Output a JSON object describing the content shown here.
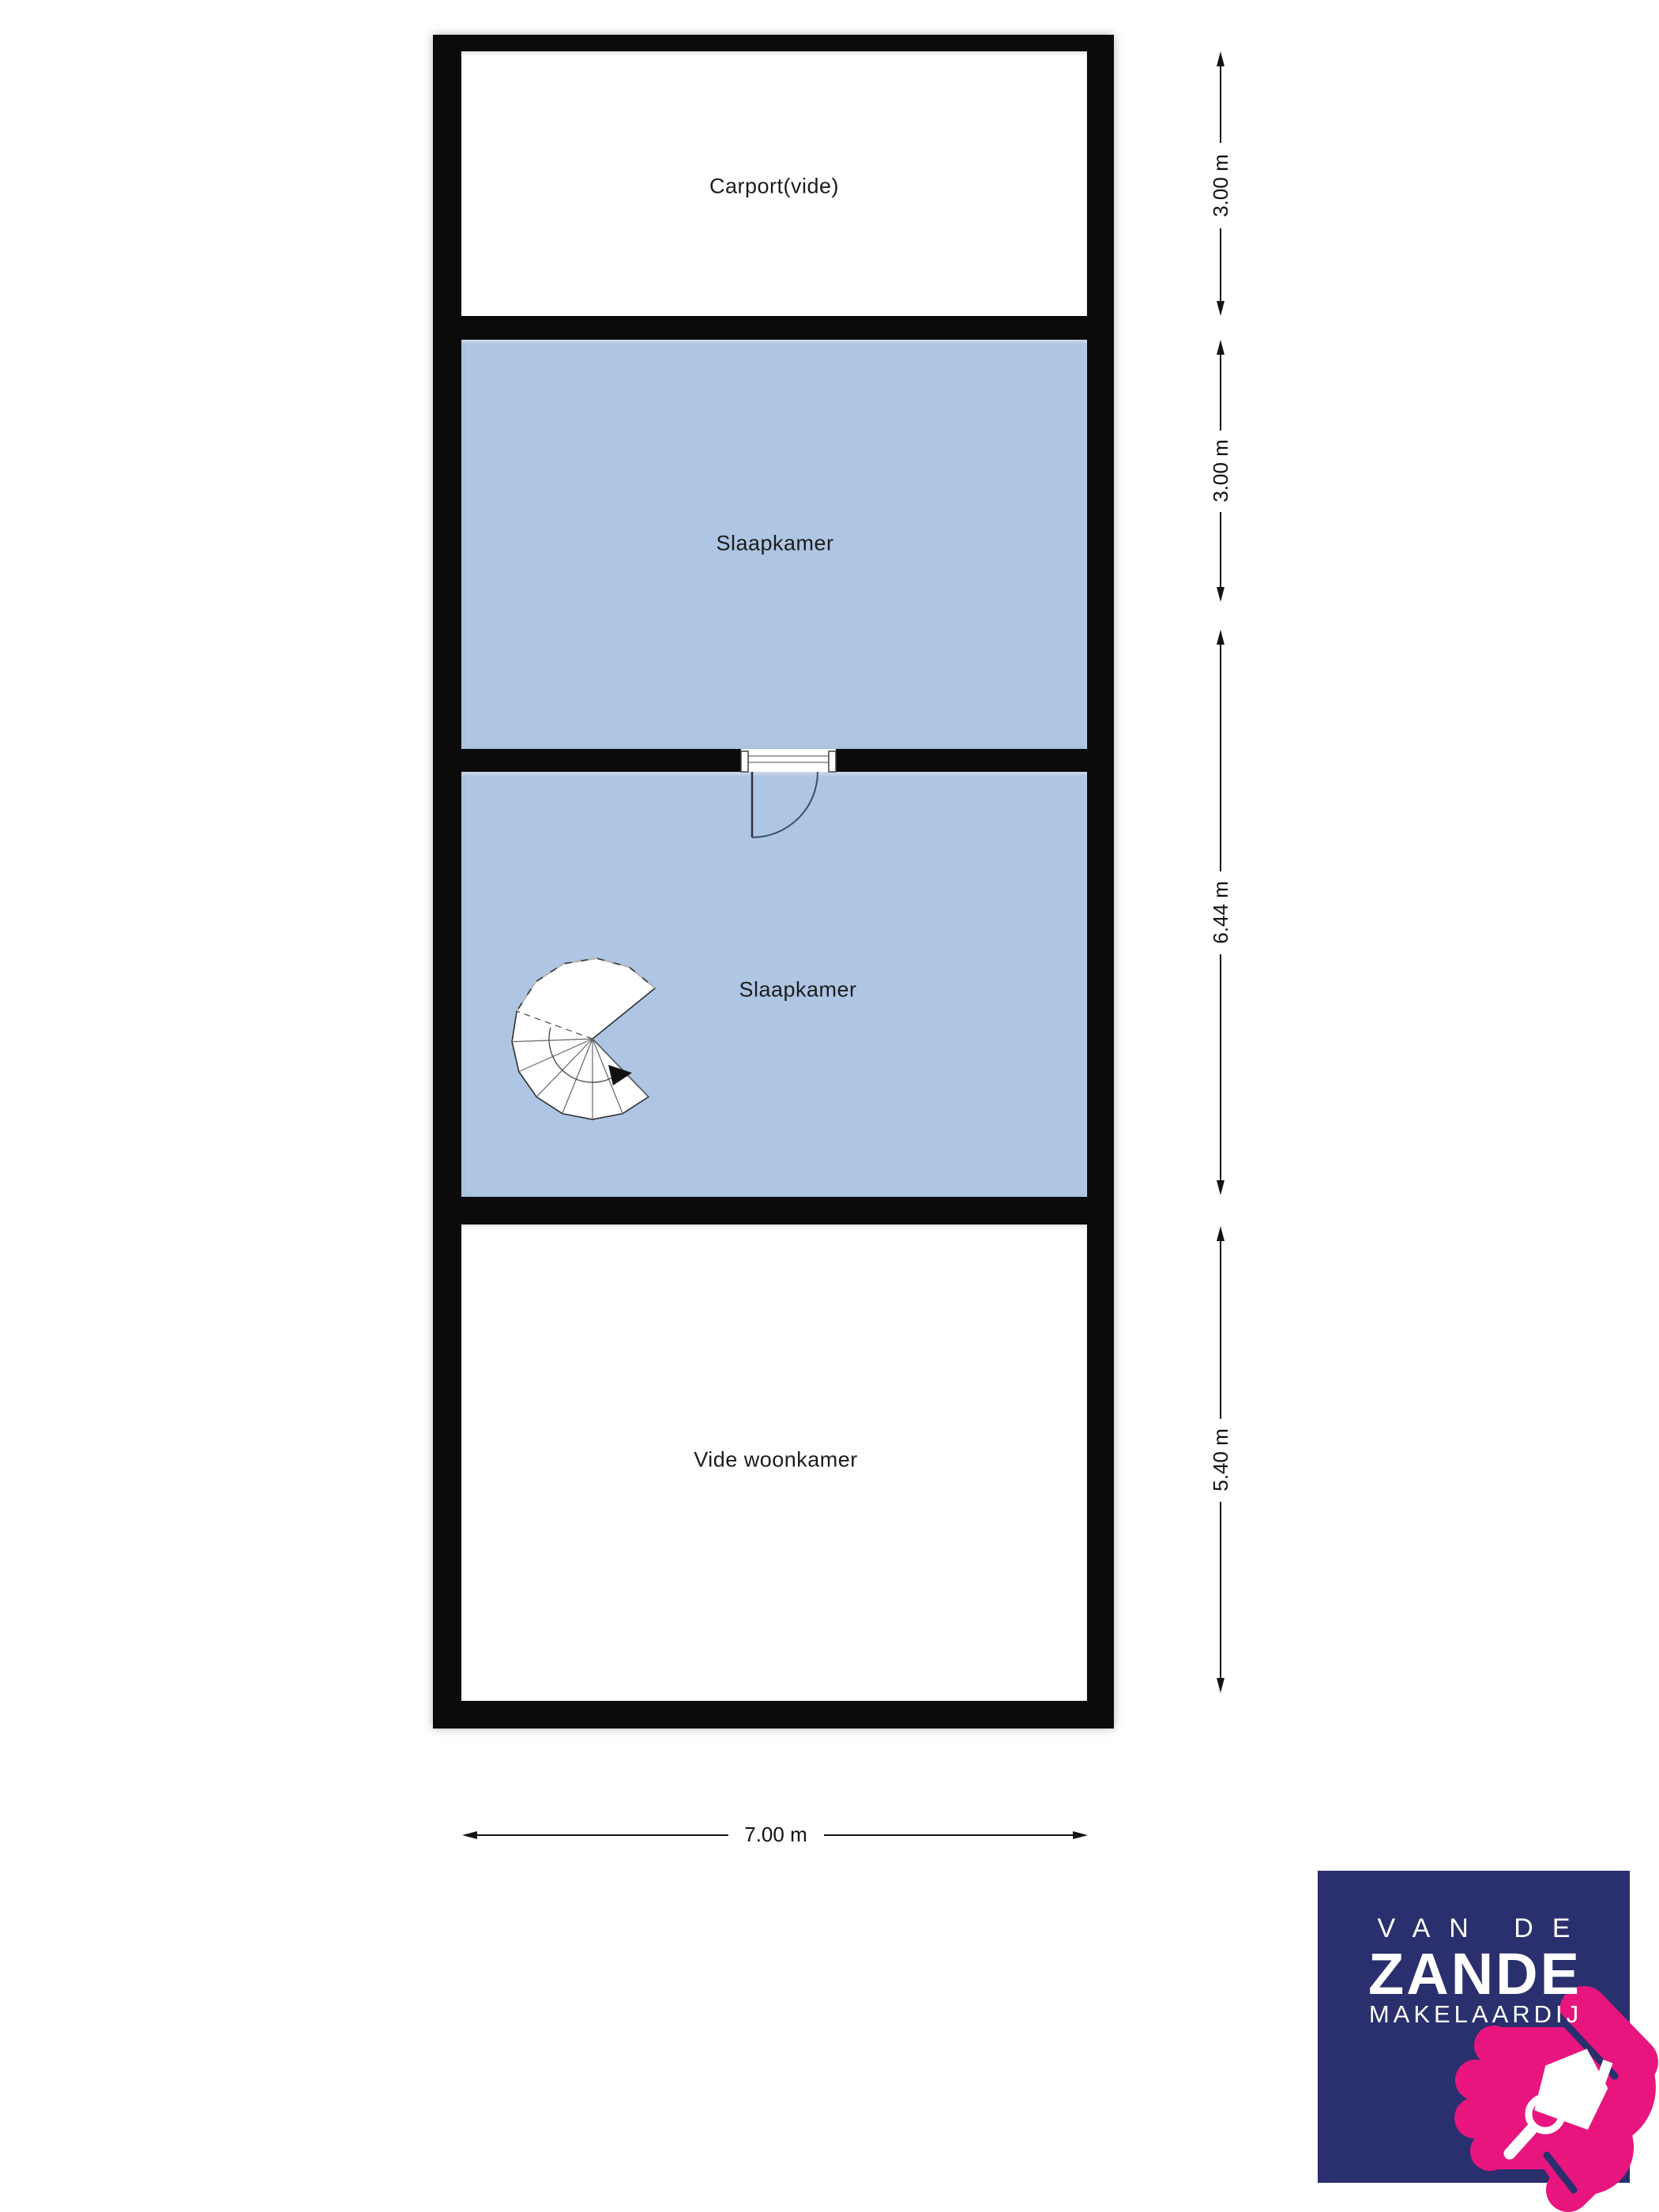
{
  "floorplan": {
    "rooms": [
      {
        "name": "carport",
        "label": "Carport(vide)",
        "fill": "white"
      },
      {
        "name": "slaapkamer-boven",
        "label": "Slaapkamer",
        "fill": "blue"
      },
      {
        "name": "slaapkamer-onder",
        "label": "Slaapkamer",
        "fill": "blue"
      },
      {
        "name": "vide-woonkamer",
        "label": "Vide woonkamer",
        "fill": "white"
      }
    ],
    "features": [
      "door-swing",
      "spiral-staircase"
    ],
    "colors": {
      "wall": "#0b0b0b",
      "room_blue": "#aec6e3",
      "room_white": "#ffffff"
    }
  },
  "dimensions": {
    "vertical": [
      {
        "label": "3.00 m"
      },
      {
        "label": "3.00 m"
      },
      {
        "label": "6.44 m"
      },
      {
        "label": "5.40 m"
      }
    ],
    "width": {
      "label": "7.00 m"
    }
  },
  "logo": {
    "line1": "VAN DE",
    "line2": "ZANDE",
    "line3": "MAKELAARDIJ",
    "colors": {
      "background": "#2a2f6e",
      "accent": "#e8157e",
      "text": "#ffffff"
    }
  }
}
